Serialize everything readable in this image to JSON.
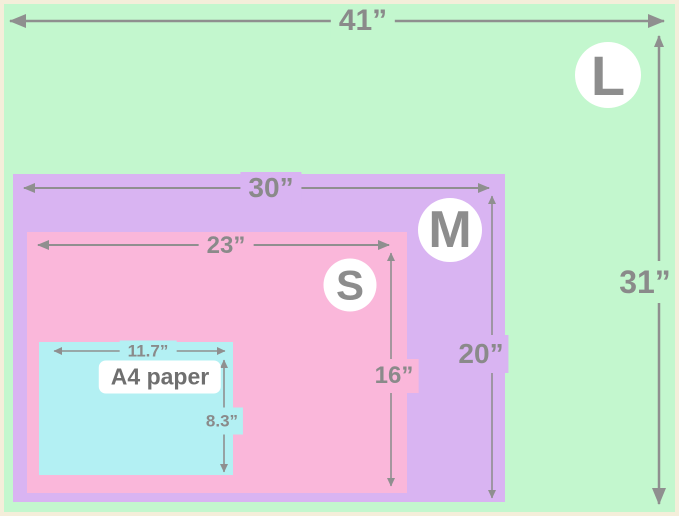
{
  "diagram_title": "size comparison diagram",
  "colors": {
    "border": "#f4eeda",
    "size_l": "#c3f7ce",
    "size_m": "#d9b4f2",
    "size_s": "#fab7da",
    "size_a4": "#b3f0f3",
    "arrow": "#8f8f8f",
    "label_text": "#8a8a8a",
    "badge_bg": "#ffffff",
    "badge_text": "#8d8d8d",
    "a4_text": "#6f6f6f"
  },
  "sizes": [
    {
      "badge": "L",
      "width_label": "41”",
      "height_label": "31”"
    },
    {
      "badge": "M",
      "width_label": "30”",
      "height_label": "20”"
    },
    {
      "badge": "S",
      "width_label": "23”",
      "height_label": "16”"
    },
    {
      "name_label": "A4 paper",
      "width_label": "11.7”",
      "height_label": "8.3”"
    }
  ]
}
